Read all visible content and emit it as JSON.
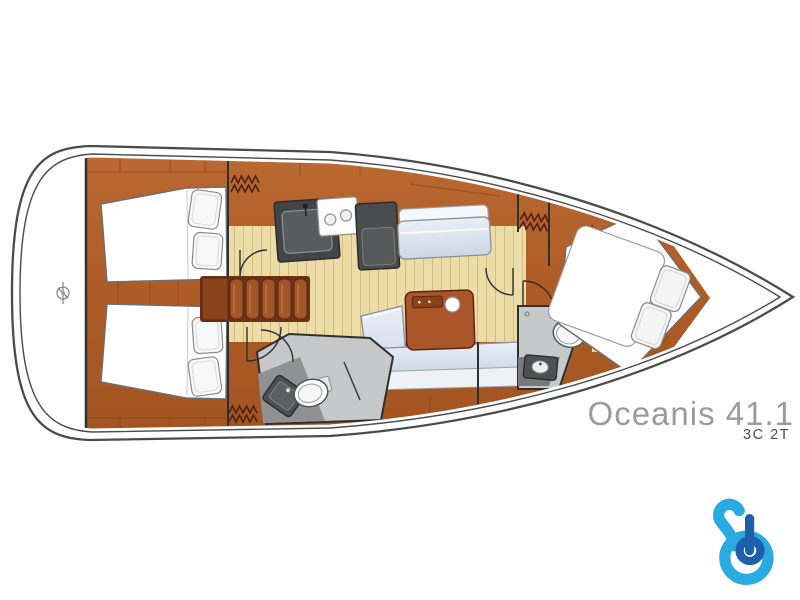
{
  "page": {
    "background_color": "#ffffff"
  },
  "branding": {
    "model_name": "Oceanis 41.1",
    "model_name_color": "#9b9b9b",
    "layout_code": "3C 2T",
    "layout_code_color": "#4d4e50",
    "logo": {
      "icon": "boataround-b-logo-icon",
      "color_light": "#29abe2",
      "color_dark": "#1d5fa9"
    }
  },
  "floorplan": {
    "type": "sailboat-deck-plan",
    "orientation": "bow-right",
    "hull_color": "#ffffff",
    "outline_color": "#4a4b4d",
    "wood_color": "#ad5c26",
    "wood_seam_color": "#8a4014",
    "floor_plank_color": "#ecdca6",
    "head_floor_color": "#c6c8ca",
    "upholstery_color": "#dbe5f0",
    "mattress_color": "#ffffff",
    "fixture_color": "#4f5052",
    "icons": [
      "steering-helm-icon",
      "hanging-locker-icon",
      "companionway-steps-icon",
      "galley-sink-icon",
      "stove-burners-icon",
      "fridge-icon",
      "saloon-table-icon",
      "cup-holder-icon",
      "toilet-icon",
      "washbasin-icon",
      "double-berth-icon",
      "pillow-icon",
      "door-swing-icon"
    ]
  }
}
